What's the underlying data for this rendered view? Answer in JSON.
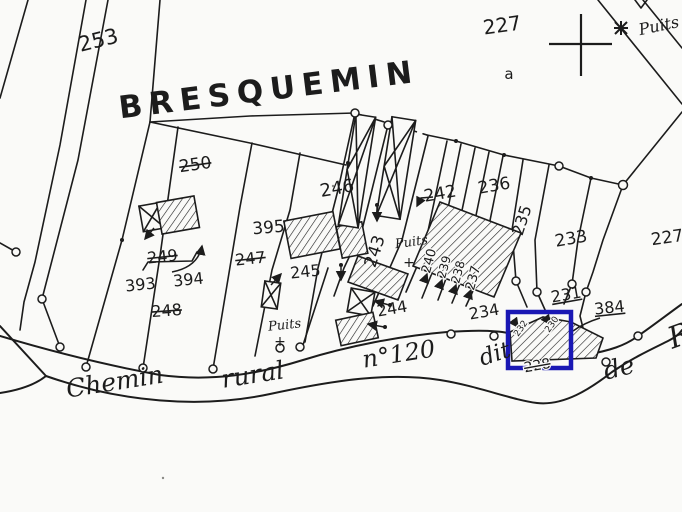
{
  "colors": {
    "ink": "#1c1c1c",
    "paper": "#fafaf8",
    "highlight": "#1a18b4"
  },
  "map": {
    "place_name": "BRESQUEMIN",
    "labels": [
      {
        "id": "parcel-253",
        "text": "253",
        "x": 100,
        "y": 47,
        "rot": -14,
        "size": 21,
        "font": "num",
        "style": "normal"
      },
      {
        "id": "lieu-dit-bresquemin",
        "text": "BRESQUEMIN",
        "x": 270,
        "y": 100,
        "rot": -7,
        "size": 31,
        "font": "title",
        "style": "normal"
      },
      {
        "id": "parcel-227",
        "text": "227",
        "x": 503,
        "y": 32,
        "rot": -8,
        "size": 20,
        "font": "num",
        "style": "normal"
      },
      {
        "id": "subdivision-a",
        "text": "a",
        "x": 509,
        "y": 79,
        "rot": 0,
        "size": 15,
        "font": "num",
        "style": "normal"
      },
      {
        "id": "well-label-top-right",
        "text": "Puits",
        "x": 660,
        "y": 31,
        "rot": -12,
        "size": 16,
        "font": "script",
        "style": "normal"
      },
      {
        "id": "parcel-250-struck",
        "text": "250",
        "x": 196,
        "y": 170,
        "rot": -8,
        "size": 17,
        "font": "num",
        "style": "struck"
      },
      {
        "id": "parcel-246",
        "text": "246",
        "x": 338,
        "y": 194,
        "rot": -10,
        "size": 18,
        "font": "num",
        "style": "normal"
      },
      {
        "id": "parcel-242",
        "text": "242",
        "x": 441,
        "y": 199,
        "rot": -10,
        "size": 17,
        "font": "num",
        "style": "normal"
      },
      {
        "id": "parcel-236",
        "text": "236",
        "x": 495,
        "y": 191,
        "rot": -10,
        "size": 17,
        "font": "num",
        "style": "normal"
      },
      {
        "id": "parcel-235",
        "text": "235",
        "x": 527,
        "y": 222,
        "rot": -72,
        "size": 16,
        "font": "num",
        "style": "normal"
      },
      {
        "id": "parcel-233",
        "text": "233",
        "x": 572,
        "y": 244,
        "rot": -10,
        "size": 17,
        "font": "num",
        "style": "normal"
      },
      {
        "id": "parcel-395",
        "text": "395",
        "x": 269,
        "y": 233,
        "rot": -5,
        "size": 17,
        "font": "num",
        "style": "normal"
      },
      {
        "id": "parcel-247-struck",
        "text": "247",
        "x": 251,
        "y": 264,
        "rot": -6,
        "size": 16,
        "font": "num",
        "style": "struck"
      },
      {
        "id": "parcel-249-struck",
        "text": "249",
        "x": 163,
        "y": 262,
        "rot": -6,
        "size": 16,
        "font": "num",
        "style": "struck"
      },
      {
        "id": "parcel-243",
        "text": "243",
        "x": 380,
        "y": 253,
        "rot": -72,
        "size": 17,
        "font": "num",
        "style": "normal"
      },
      {
        "id": "well-label-center",
        "text": "Puits",
        "x": 412,
        "y": 246,
        "rot": -8,
        "size": 13,
        "font": "script",
        "style": "normal"
      },
      {
        "id": "well-cross-center",
        "text": "+",
        "x": 409,
        "y": 267,
        "rot": 0,
        "size": 14,
        "font": "num",
        "style": "normal"
      },
      {
        "id": "parcel-240",
        "text": "240",
        "x": 433,
        "y": 262,
        "rot": -75,
        "size": 13,
        "font": "num",
        "style": "normal",
        "halo": true
      },
      {
        "id": "parcel-239",
        "text": "239",
        "x": 448,
        "y": 268,
        "rot": -75,
        "size": 12,
        "font": "num",
        "style": "normal",
        "halo": true
      },
      {
        "id": "parcel-238",
        "text": "238",
        "x": 462,
        "y": 273,
        "rot": -75,
        "size": 12,
        "font": "num",
        "style": "normal",
        "halo": true
      },
      {
        "id": "parcel-237",
        "text": "237",
        "x": 477,
        "y": 279,
        "rot": -75,
        "size": 13,
        "font": "num",
        "style": "normal",
        "halo": true
      },
      {
        "id": "parcel-393",
        "text": "393",
        "x": 141,
        "y": 290,
        "rot": -6,
        "size": 16,
        "font": "num",
        "style": "normal"
      },
      {
        "id": "parcel-394",
        "text": "394",
        "x": 189,
        "y": 285,
        "rot": -6,
        "size": 16,
        "font": "num",
        "style": "normal"
      },
      {
        "id": "parcel-248-struck",
        "text": "248",
        "x": 167,
        "y": 316,
        "rot": -4,
        "size": 16,
        "font": "num",
        "style": "struck"
      },
      {
        "id": "parcel-245",
        "text": "245",
        "x": 306,
        "y": 277,
        "rot": -6,
        "size": 16,
        "font": "num",
        "style": "normal"
      },
      {
        "id": "well-label-south",
        "text": "Puits",
        "x": 285,
        "y": 329,
        "rot": -6,
        "size": 13,
        "font": "script",
        "style": "normal"
      },
      {
        "id": "well-cross-south",
        "text": "+",
        "x": 280,
        "y": 346,
        "rot": 0,
        "size": 14,
        "font": "num",
        "style": "normal"
      },
      {
        "id": "parcel-244",
        "text": "244",
        "x": 393,
        "y": 314,
        "rot": -10,
        "size": 16,
        "font": "num",
        "style": "normal"
      },
      {
        "id": "parcel-234",
        "text": "234",
        "x": 485,
        "y": 317,
        "rot": -10,
        "size": 16,
        "font": "num",
        "style": "normal"
      },
      {
        "id": "parcel-231",
        "text": "231",
        "x": 567,
        "y": 300,
        "rot": -10,
        "size": 16,
        "font": "num",
        "style": "underline"
      },
      {
        "id": "parcel-384",
        "text": "384",
        "x": 610,
        "y": 313,
        "rot": -6,
        "size": 16,
        "font": "num",
        "style": "underline"
      },
      {
        "id": "parcel-232-small",
        "text": "232",
        "x": 523,
        "y": 330,
        "rot": -55,
        "size": 9,
        "font": "num",
        "style": "normal",
        "halo": true
      },
      {
        "id": "parcel-230-small",
        "text": "230",
        "x": 554,
        "y": 326,
        "rot": -55,
        "size": 9,
        "font": "num",
        "style": "normal",
        "halo": true
      },
      {
        "id": "parcel-228-struck",
        "text": "228",
        "x": 538,
        "y": 370,
        "rot": -10,
        "size": 14,
        "font": "num",
        "style": "struck",
        "halo": true
      },
      {
        "id": "road-name-chemin",
        "text": "Chemin",
        "x": 116,
        "y": 390,
        "rot": -9,
        "size": 25,
        "font": "script",
        "style": "normal"
      },
      {
        "id": "road-name-rural",
        "text": "rural",
        "x": 254,
        "y": 383,
        "rot": -9,
        "size": 25,
        "font": "script",
        "style": "normal"
      },
      {
        "id": "road-name-n120",
        "text": "n°120",
        "x": 400,
        "y": 362,
        "rot": -9,
        "size": 24,
        "font": "script",
        "style": "normal"
      },
      {
        "id": "road-name-dit",
        "text": "dit",
        "x": 497,
        "y": 361,
        "rot": -18,
        "size": 23,
        "font": "script",
        "style": "normal"
      },
      {
        "id": "road-name-de",
        "text": "de",
        "x": 621,
        "y": 376,
        "rot": -14,
        "size": 25,
        "font": "script",
        "style": "normal"
      },
      {
        "id": "road-name-partial-letter",
        "text": "R",
        "x": 683,
        "y": 345,
        "rot": -20,
        "size": 30,
        "font": "script",
        "style": "normal"
      },
      {
        "id": "parcel-227-right-edge-partial",
        "text": "227",
        "x": 668,
        "y": 243,
        "rot": -8,
        "size": 17,
        "font": "num",
        "style": "normal"
      }
    ]
  }
}
